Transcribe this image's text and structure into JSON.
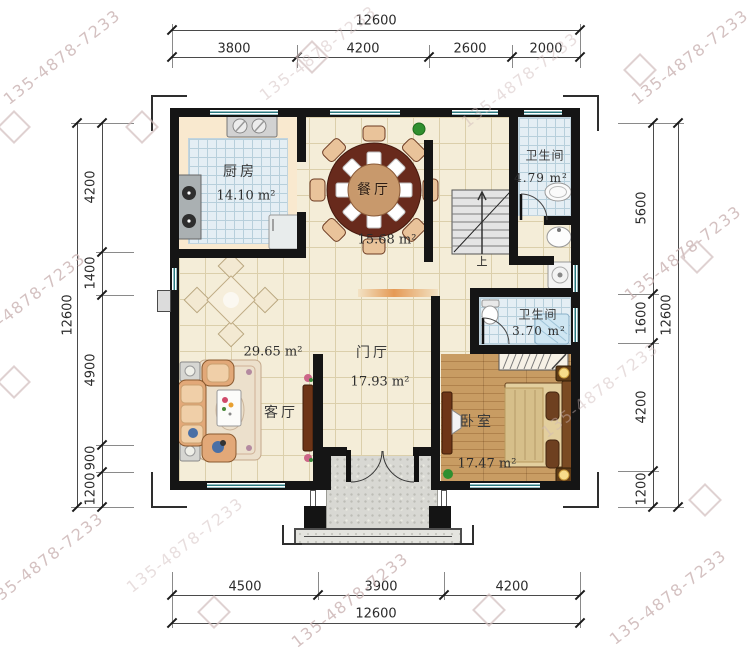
{
  "watermark": {
    "text": "135-4878-7233"
  },
  "dimensions": {
    "top": {
      "overall": "12600",
      "segments": [
        "3800",
        "4200",
        "2600",
        "2000"
      ]
    },
    "bottom": {
      "overall": "12600",
      "segments": [
        "4500",
        "3900",
        "4200"
      ]
    },
    "left": {
      "overall": "12600",
      "segments": [
        "4200",
        "1400",
        "4900",
        "900",
        "1200"
      ]
    },
    "right": {
      "overall": "12600",
      "segments": [
        "5600",
        "1600",
        "4200",
        "1200"
      ]
    }
  },
  "rooms": {
    "kitchen": {
      "name": "厨房",
      "area": "14.10 m²"
    },
    "dining": {
      "name": "餐厅",
      "area": "15.68 m²"
    },
    "bath_upper": {
      "name": "卫生间",
      "area": "4.79 m²"
    },
    "bath_lower": {
      "name": "卫生间",
      "area": "3.70 m²"
    },
    "foyer": {
      "name": "门厅",
      "area": "17.93 m²"
    },
    "living": {
      "name": "客厅",
      "area": "29.65 m²"
    },
    "bedroom": {
      "name": "卧室",
      "area": "17.47 m²"
    }
  },
  "stairs": {
    "up_label": "上"
  },
  "colors": {
    "wall": "#151515",
    "window": "#2a7a80",
    "floor_cream": "#f4edd8",
    "floor_blue": "#e4eef4",
    "wood": "#c89c63",
    "watermark": "#cdb7b7"
  }
}
